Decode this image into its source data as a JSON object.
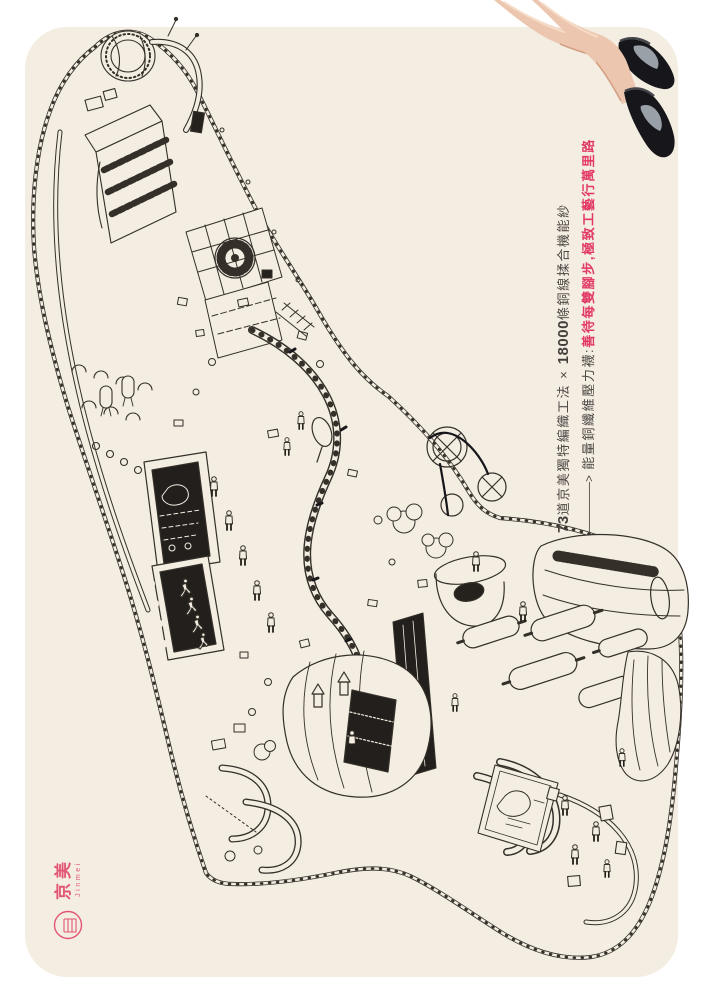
{
  "poster": {
    "headline": {
      "line1_num1": "73",
      "line1_part1": "道京美獨特編織工法 × ",
      "line1_num2": "18000",
      "line1_part2": "條銅線揉合機能紗",
      "line2_arrow": "──────>",
      "line2_dark": " 能量銅纖維壓力襪:",
      "line2_red": "善待每雙腳步,極致工藝行萬里路"
    },
    "seal": {
      "brand_zh": "京美",
      "brand_en": "Jinmei"
    },
    "colors": {
      "card_bg": "#f4ede2",
      "ink": "#343029",
      "headline_text": "#4e4844",
      "headline_accent": "#e23a64",
      "seal_pink": "#e25674",
      "sock_black": "#17171b",
      "sock_gray": "#9aa0a8",
      "skin": "#ecc6ae"
    }
  }
}
